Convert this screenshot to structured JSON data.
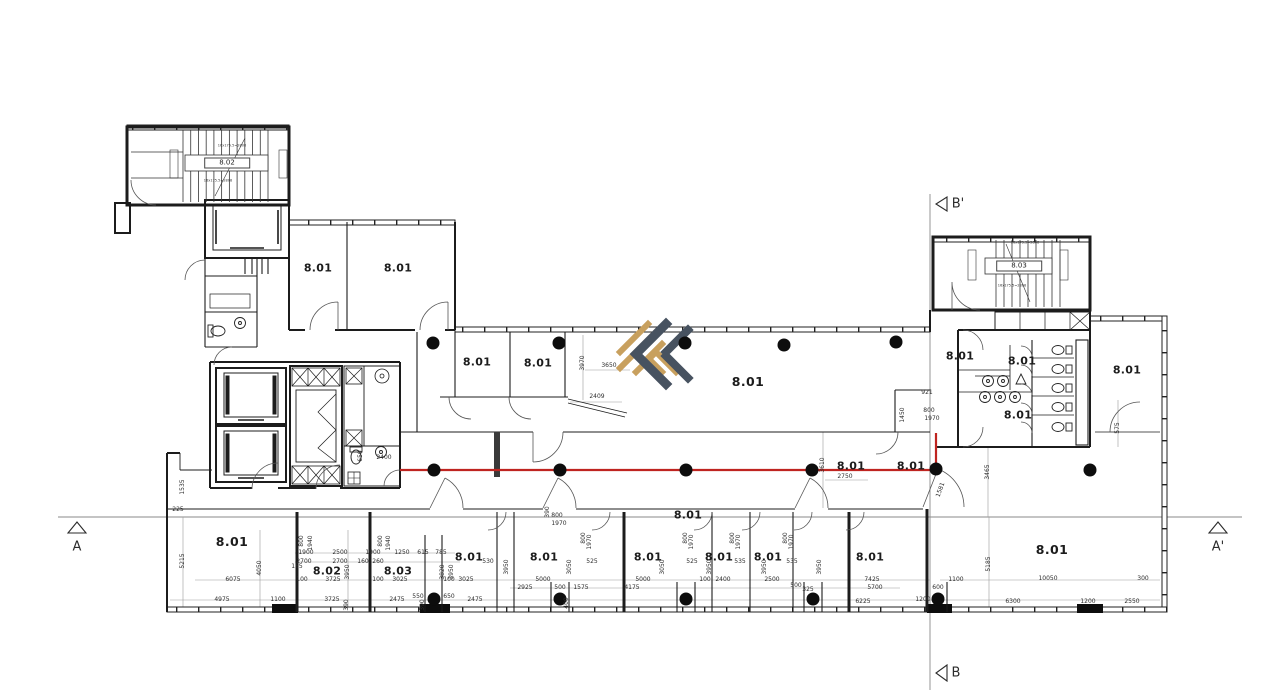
{
  "drawing": {
    "type": "architectural-floor-plan",
    "wall_color": "#1c1c1c",
    "background": "#ffffff"
  },
  "section_markers": [
    {
      "label": "A",
      "x": 77,
      "y": 547,
      "triangle": "up"
    },
    {
      "label": "A'",
      "x": 1218,
      "y": 547,
      "triangle": "up"
    },
    {
      "label": "B'",
      "x": 958,
      "y": 204,
      "triangle": "left"
    },
    {
      "label": "B",
      "x": 956,
      "y": 673,
      "triangle": "left"
    }
  ],
  "structure": {
    "route": {
      "color": "#bf2420",
      "width": 2.2,
      "points": [
        [
          400,
          470
        ],
        [
          936,
          470
        ],
        [
          936,
          433
        ]
      ]
    },
    "dots": {
      "color": "#0d0d0d",
      "radius": 6.5,
      "positions": [
        [
          433,
          343
        ],
        [
          559,
          343
        ],
        [
          685,
          343
        ],
        [
          784,
          345
        ],
        [
          896,
          342
        ],
        [
          434,
          470
        ],
        [
          560,
          470
        ],
        [
          686,
          470
        ],
        [
          812,
          470
        ],
        [
          936,
          469
        ],
        [
          1090,
          470
        ],
        [
          434,
          599
        ],
        [
          560,
          599
        ],
        [
          686,
          599
        ],
        [
          813,
          599
        ],
        [
          938,
          599
        ]
      ]
    },
    "logo_colors": {
      "gold": "#c8a05e",
      "slate": "#475260"
    }
  },
  "labels": [
    {
      "t": "8.01",
      "x": 318,
      "y": 268,
      "c": "room"
    },
    {
      "t": "8.01",
      "x": 398,
      "y": 268,
      "c": "room"
    },
    {
      "t": "8.01",
      "x": 477,
      "y": 362,
      "c": "room"
    },
    {
      "t": "8.01",
      "x": 538,
      "y": 363,
      "c": "room"
    },
    {
      "t": "8.01",
      "x": 748,
      "y": 382,
      "c": "room-lg"
    },
    {
      "t": "8.01",
      "x": 851,
      "y": 466,
      "c": "room"
    },
    {
      "t": "8.01",
      "x": 911,
      "y": 466,
      "c": "room"
    },
    {
      "t": "8.01",
      "x": 960,
      "y": 356,
      "c": "room"
    },
    {
      "t": "8.01",
      "x": 1022,
      "y": 361,
      "c": "room"
    },
    {
      "t": "8.01",
      "x": 1018,
      "y": 415,
      "c": "room"
    },
    {
      "t": "8.01",
      "x": 1127,
      "y": 370,
      "c": "room"
    },
    {
      "t": "8.01",
      "x": 232,
      "y": 542,
      "c": "room-lg"
    },
    {
      "t": "8.02",
      "x": 327,
      "y": 571,
      "c": "room"
    },
    {
      "t": "8.03",
      "x": 398,
      "y": 571,
      "c": "room"
    },
    {
      "t": "8.01",
      "x": 469,
      "y": 557,
      "c": "room"
    },
    {
      "t": "8.01",
      "x": 544,
      "y": 557,
      "c": "room"
    },
    {
      "t": "8.01",
      "x": 648,
      "y": 557,
      "c": "room"
    },
    {
      "t": "8.01",
      "x": 719,
      "y": 557,
      "c": "room"
    },
    {
      "t": "8.01",
      "x": 768,
      "y": 557,
      "c": "room"
    },
    {
      "t": "8.01",
      "x": 870,
      "y": 557,
      "c": "room"
    },
    {
      "t": "8.01",
      "x": 1052,
      "y": 550,
      "c": "room-lg"
    },
    {
      "t": "8.01",
      "x": 688,
      "y": 515,
      "c": "room"
    },
    {
      "t": "8.02",
      "x": 227,
      "y": 163,
      "c": "boxed"
    },
    {
      "t": "8.03",
      "x": 1019,
      "y": 266,
      "c": "boxed"
    },
    {
      "t": "A",
      "x": 77,
      "y": 547,
      "c": "sec"
    },
    {
      "t": "A'",
      "x": 1218,
      "y": 547,
      "c": "sec"
    },
    {
      "t": "B'",
      "x": 958,
      "y": 204,
      "c": "sec"
    },
    {
      "t": "B",
      "x": 956,
      "y": 673,
      "c": "sec"
    },
    {
      "t": "16x175.5=2808",
      "x": 232,
      "y": 146,
      "c": "tiny"
    },
    {
      "t": "16x175.5=2808",
      "x": 218,
      "y": 181,
      "c": "tiny"
    },
    {
      "t": "16x175.5=2808",
      "x": 1025,
      "y": 243,
      "c": "tiny"
    },
    {
      "t": "16x175.5=2808",
      "x": 1012,
      "y": 286,
      "c": "tiny"
    },
    {
      "t": "225",
      "x": 178,
      "y": 510,
      "c": "dim"
    },
    {
      "t": "6075",
      "x": 233,
      "y": 580,
      "c": "dim"
    },
    {
      "t": "4975",
      "x": 222,
      "y": 600,
      "c": "dim"
    },
    {
      "t": "1100",
      "x": 278,
      "y": 600,
      "c": "dim"
    },
    {
      "t": "1900",
      "x": 306,
      "y": 553,
      "c": "dim"
    },
    {
      "t": "2500",
      "x": 340,
      "y": 553,
      "c": "dim"
    },
    {
      "t": "2700",
      "x": 304,
      "y": 562,
      "c": "dim"
    },
    {
      "t": "2700",
      "x": 340,
      "y": 562,
      "c": "dim"
    },
    {
      "t": "165",
      "x": 297,
      "y": 567,
      "c": "dim"
    },
    {
      "t": "100",
      "x": 302,
      "y": 580,
      "c": "dim"
    },
    {
      "t": "3725",
      "x": 333,
      "y": 580,
      "c": "dim"
    },
    {
      "t": "3725",
      "x": 332,
      "y": 600,
      "c": "dim"
    },
    {
      "t": "1900",
      "x": 373,
      "y": 553,
      "c": "dim"
    },
    {
      "t": "1250",
      "x": 402,
      "y": 553,
      "c": "dim"
    },
    {
      "t": "160",
      "x": 363,
      "y": 562,
      "c": "dim"
    },
    {
      "t": "260",
      "x": 378,
      "y": 562,
      "c": "dim"
    },
    {
      "t": "100",
      "x": 378,
      "y": 580,
      "c": "dim"
    },
    {
      "t": "3025",
      "x": 400,
      "y": 580,
      "c": "dim"
    },
    {
      "t": "2475",
      "x": 397,
      "y": 600,
      "c": "dim"
    },
    {
      "t": "615",
      "x": 423,
      "y": 553,
      "c": "dim"
    },
    {
      "t": "785",
      "x": 441,
      "y": 553,
      "c": "dim"
    },
    {
      "t": "550",
      "x": 418,
      "y": 597,
      "c": "dim"
    },
    {
      "t": "650",
      "x": 449,
      "y": 597,
      "c": "dim"
    },
    {
      "t": "100",
      "x": 449,
      "y": 580,
      "c": "dim"
    },
    {
      "t": "3025",
      "x": 466,
      "y": 580,
      "c": "dim"
    },
    {
      "t": "2475",
      "x": 475,
      "y": 600,
      "c": "dim"
    },
    {
      "t": "530",
      "x": 488,
      "y": 562,
      "c": "dim"
    },
    {
      "t": "2925",
      "x": 525,
      "y": 588,
      "c": "dim"
    },
    {
      "t": "5000",
      "x": 543,
      "y": 580,
      "c": "dim"
    },
    {
      "t": "500",
      "x": 560,
      "y": 588,
      "c": "dim"
    },
    {
      "t": "1575",
      "x": 581,
      "y": 588,
      "c": "dim"
    },
    {
      "t": "525",
      "x": 592,
      "y": 562,
      "c": "dim"
    },
    {
      "t": "4175",
      "x": 632,
      "y": 588,
      "c": "dim"
    },
    {
      "t": "5000",
      "x": 643,
      "y": 580,
      "c": "dim"
    },
    {
      "t": "525",
      "x": 692,
      "y": 562,
      "c": "dim"
    },
    {
      "t": "100",
      "x": 705,
      "y": 580,
      "c": "dim"
    },
    {
      "t": "2400",
      "x": 723,
      "y": 580,
      "c": "dim"
    },
    {
      "t": "535",
      "x": 740,
      "y": 562,
      "c": "dim"
    },
    {
      "t": "535",
      "x": 792,
      "y": 562,
      "c": "dim"
    },
    {
      "t": "2500",
      "x": 772,
      "y": 580,
      "c": "dim"
    },
    {
      "t": "500",
      "x": 796,
      "y": 586,
      "c": "dim"
    },
    {
      "t": "325",
      "x": 808,
      "y": 590,
      "c": "dim"
    },
    {
      "t": "7425",
      "x": 872,
      "y": 580,
      "c": "dim"
    },
    {
      "t": "5700",
      "x": 875,
      "y": 588,
      "c": "dim"
    },
    {
      "t": "6225",
      "x": 863,
      "y": 602,
      "c": "dim"
    },
    {
      "t": "1200",
      "x": 923,
      "y": 600,
      "c": "dim"
    },
    {
      "t": "600",
      "x": 938,
      "y": 588,
      "c": "dim"
    },
    {
      "t": "1100",
      "x": 956,
      "y": 580,
      "c": "dim"
    },
    {
      "t": "10050",
      "x": 1048,
      "y": 579,
      "c": "dim"
    },
    {
      "t": "300",
      "x": 1143,
      "y": 579,
      "c": "dim"
    },
    {
      "t": "6300",
      "x": 1013,
      "y": 602,
      "c": "dim"
    },
    {
      "t": "1200",
      "x": 1088,
      "y": 602,
      "c": "dim"
    },
    {
      "t": "2550",
      "x": 1132,
      "y": 602,
      "c": "dim"
    },
    {
      "t": "2409",
      "x": 597,
      "y": 397,
      "c": "dim"
    },
    {
      "t": "3650",
      "x": 609,
      "y": 366,
      "c": "dim"
    },
    {
      "t": "921",
      "x": 927,
      "y": 393,
      "c": "dim"
    },
    {
      "t": "800",
      "x": 929,
      "y": 411,
      "c": "dim"
    },
    {
      "t": "1970",
      "x": 932,
      "y": 419,
      "c": "dim"
    },
    {
      "t": "2750",
      "x": 845,
      "y": 477,
      "c": "dim"
    },
    {
      "t": "800",
      "x": 557,
      "y": 516,
      "c": "dim"
    },
    {
      "t": "1970",
      "x": 559,
      "y": 524,
      "c": "dim"
    },
    {
      "t": "2400",
      "x": 384,
      "y": 458,
      "c": "dim"
    },
    {
      "t": "5215",
      "x": 183,
      "y": 561,
      "c": "dimv",
      "rot": -90
    },
    {
      "t": "4050",
      "x": 260,
      "y": 568,
      "c": "dimv",
      "rot": -90
    },
    {
      "t": "1535",
      "x": 183,
      "y": 487,
      "c": "dimv",
      "rot": -90
    },
    {
      "t": "800",
      "x": 302,
      "y": 541,
      "c": "dimv",
      "rot": -90
    },
    {
      "t": "1940",
      "x": 311,
      "y": 543,
      "c": "dimv",
      "rot": -90
    },
    {
      "t": "3950",
      "x": 348,
      "y": 572,
      "c": "dimv",
      "rot": -90
    },
    {
      "t": "390",
      "x": 347,
      "y": 605,
      "c": "dimv",
      "rot": -90
    },
    {
      "t": "800",
      "x": 381,
      "y": 541,
      "c": "dimv",
      "rot": -90
    },
    {
      "t": "1940",
      "x": 389,
      "y": 543,
      "c": "dimv",
      "rot": -90
    },
    {
      "t": "3820",
      "x": 443,
      "y": 572,
      "c": "dimv",
      "rot": -90
    },
    {
      "t": "3950",
      "x": 452,
      "y": 572,
      "c": "dimv",
      "rot": -90
    },
    {
      "t": "390",
      "x": 423,
      "y": 605,
      "c": "dimv",
      "rot": -90
    },
    {
      "t": "3950",
      "x": 507,
      "y": 567,
      "c": "dimv",
      "rot": -90
    },
    {
      "t": "3050",
      "x": 570,
      "y": 567,
      "c": "dimv",
      "rot": -90
    },
    {
      "t": "400",
      "x": 567,
      "y": 603,
      "c": "dimv",
      "rot": -90
    },
    {
      "t": "390",
      "x": 548,
      "y": 512,
      "c": "dimv",
      "rot": -90
    },
    {
      "t": "800",
      "x": 584,
      "y": 538,
      "c": "dimv",
      "rot": -90
    },
    {
      "t": "1970",
      "x": 590,
      "y": 542,
      "c": "dimv",
      "rot": -90
    },
    {
      "t": "3050",
      "x": 663,
      "y": 567,
      "c": "dimv",
      "rot": -90
    },
    {
      "t": "800",
      "x": 686,
      "y": 538,
      "c": "dimv",
      "rot": -90
    },
    {
      "t": "1970",
      "x": 692,
      "y": 542,
      "c": "dimv",
      "rot": -90
    },
    {
      "t": "3950",
      "x": 710,
      "y": 567,
      "c": "dimv",
      "rot": -90
    },
    {
      "t": "3950",
      "x": 765,
      "y": 567,
      "c": "dimv",
      "rot": -90
    },
    {
      "t": "800",
      "x": 733,
      "y": 538,
      "c": "dimv",
      "rot": -90
    },
    {
      "t": "1970",
      "x": 739,
      "y": 542,
      "c": "dimv",
      "rot": -90
    },
    {
      "t": "800",
      "x": 786,
      "y": 538,
      "c": "dimv",
      "rot": -90
    },
    {
      "t": "1970",
      "x": 792,
      "y": 542,
      "c": "dimv",
      "rot": -90
    },
    {
      "t": "3950",
      "x": 820,
      "y": 567,
      "c": "dimv",
      "rot": -90
    },
    {
      "t": "5185",
      "x": 989,
      "y": 564,
      "c": "dimv",
      "rot": -90
    },
    {
      "t": "3970",
      "x": 583,
      "y": 363,
      "c": "dimv",
      "rot": -90
    },
    {
      "t": "1450",
      "x": 903,
      "y": 415,
      "c": "dimv",
      "rot": -90
    },
    {
      "t": "3610",
      "x": 823,
      "y": 465,
      "c": "dimv",
      "rot": -90
    },
    {
      "t": "3465",
      "x": 988,
      "y": 472,
      "c": "dimv",
      "rot": -90
    },
    {
      "t": "575",
      "x": 1118,
      "y": 428,
      "c": "dimv",
      "rot": -90
    },
    {
      "t": "650",
      "x": 361,
      "y": 456,
      "c": "dimv",
      "rot": -90
    },
    {
      "t": "1581",
      "x": 941,
      "y": 490,
      "c": "dimv",
      "rot": -70
    }
  ]
}
